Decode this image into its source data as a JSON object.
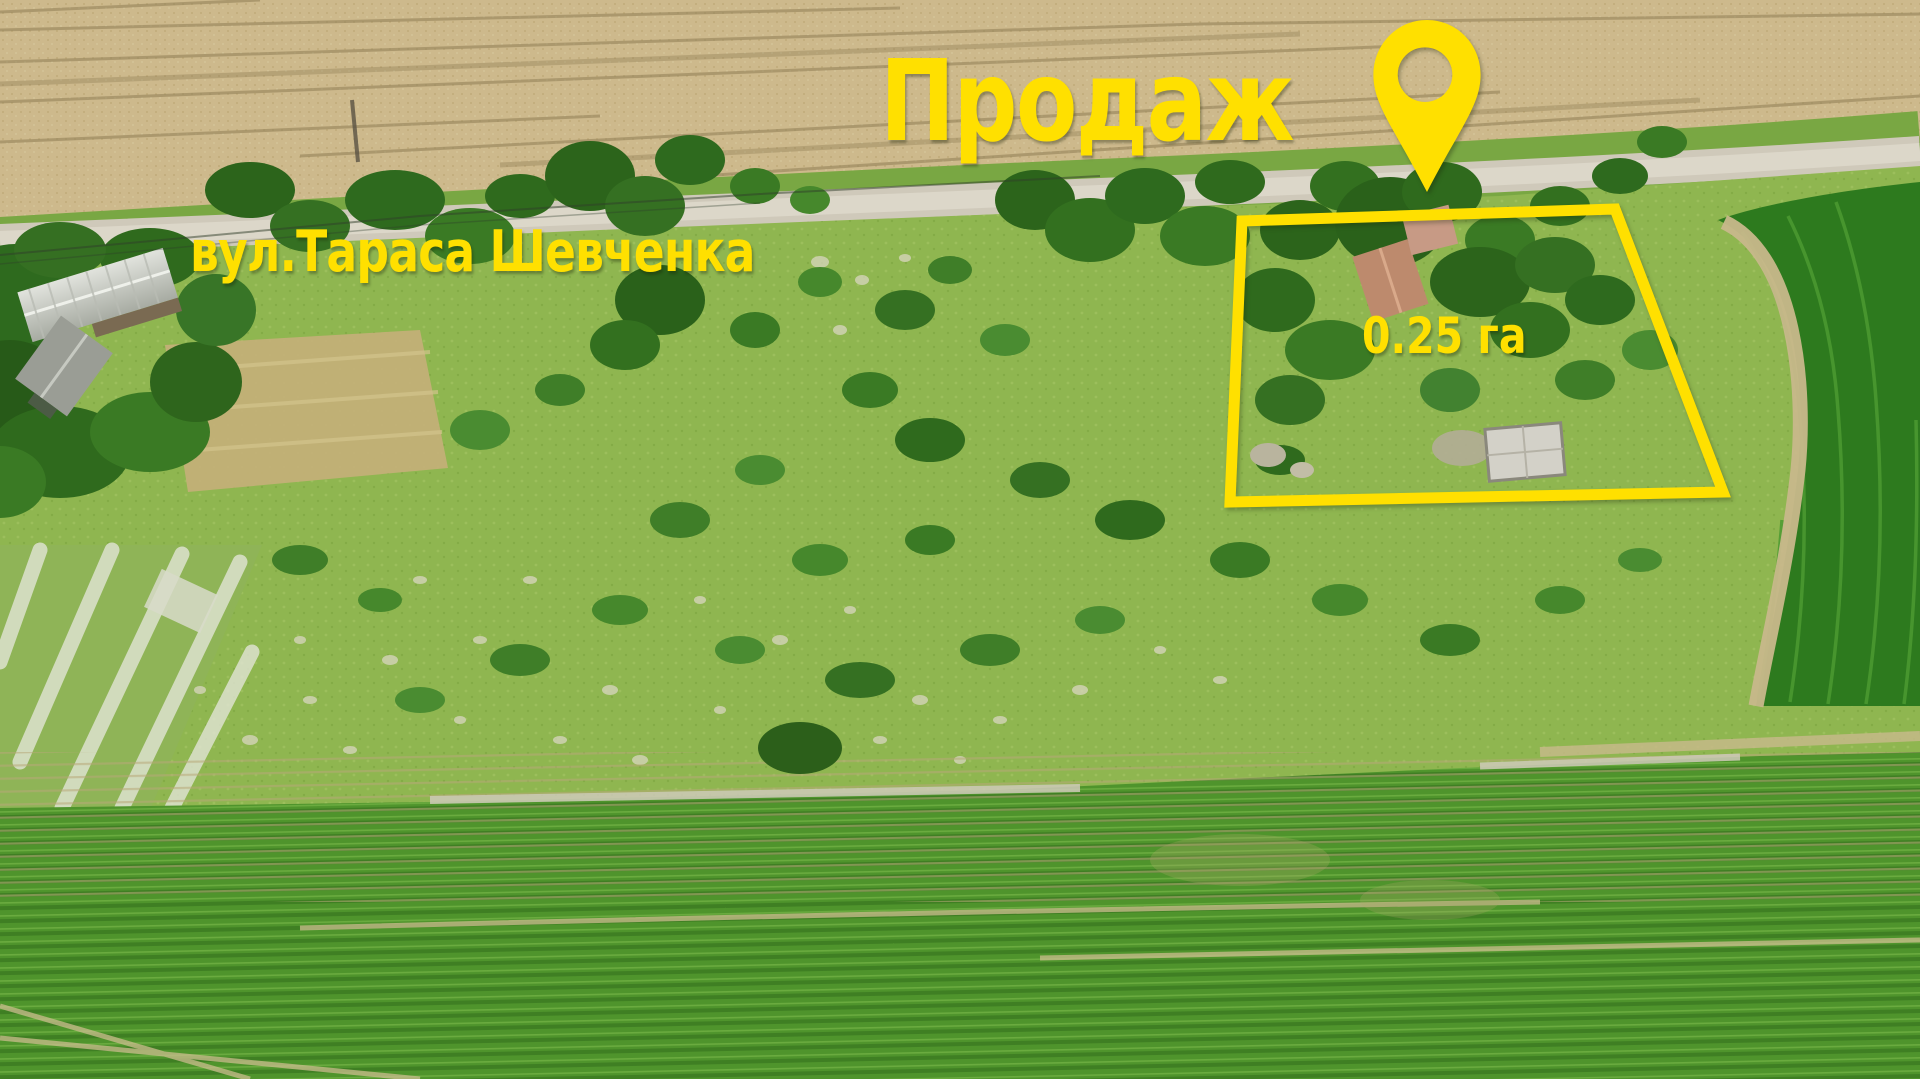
{
  "overlay": {
    "title": "Продаж",
    "street_label": "вул.Тараса Шевченка",
    "area_label": "0.25 га",
    "accent_color": "#FFE000",
    "pin_icon": "location-pin-icon"
  },
  "scene_colors": {
    "wheat_field": "#cdb98c",
    "dirt_road": "#d4cfc0",
    "meadow": "#8fb650",
    "dark_trees": "#2c641b",
    "young_corn_field": "#4f942c",
    "mature_corn_field": "#2d7a1e"
  }
}
